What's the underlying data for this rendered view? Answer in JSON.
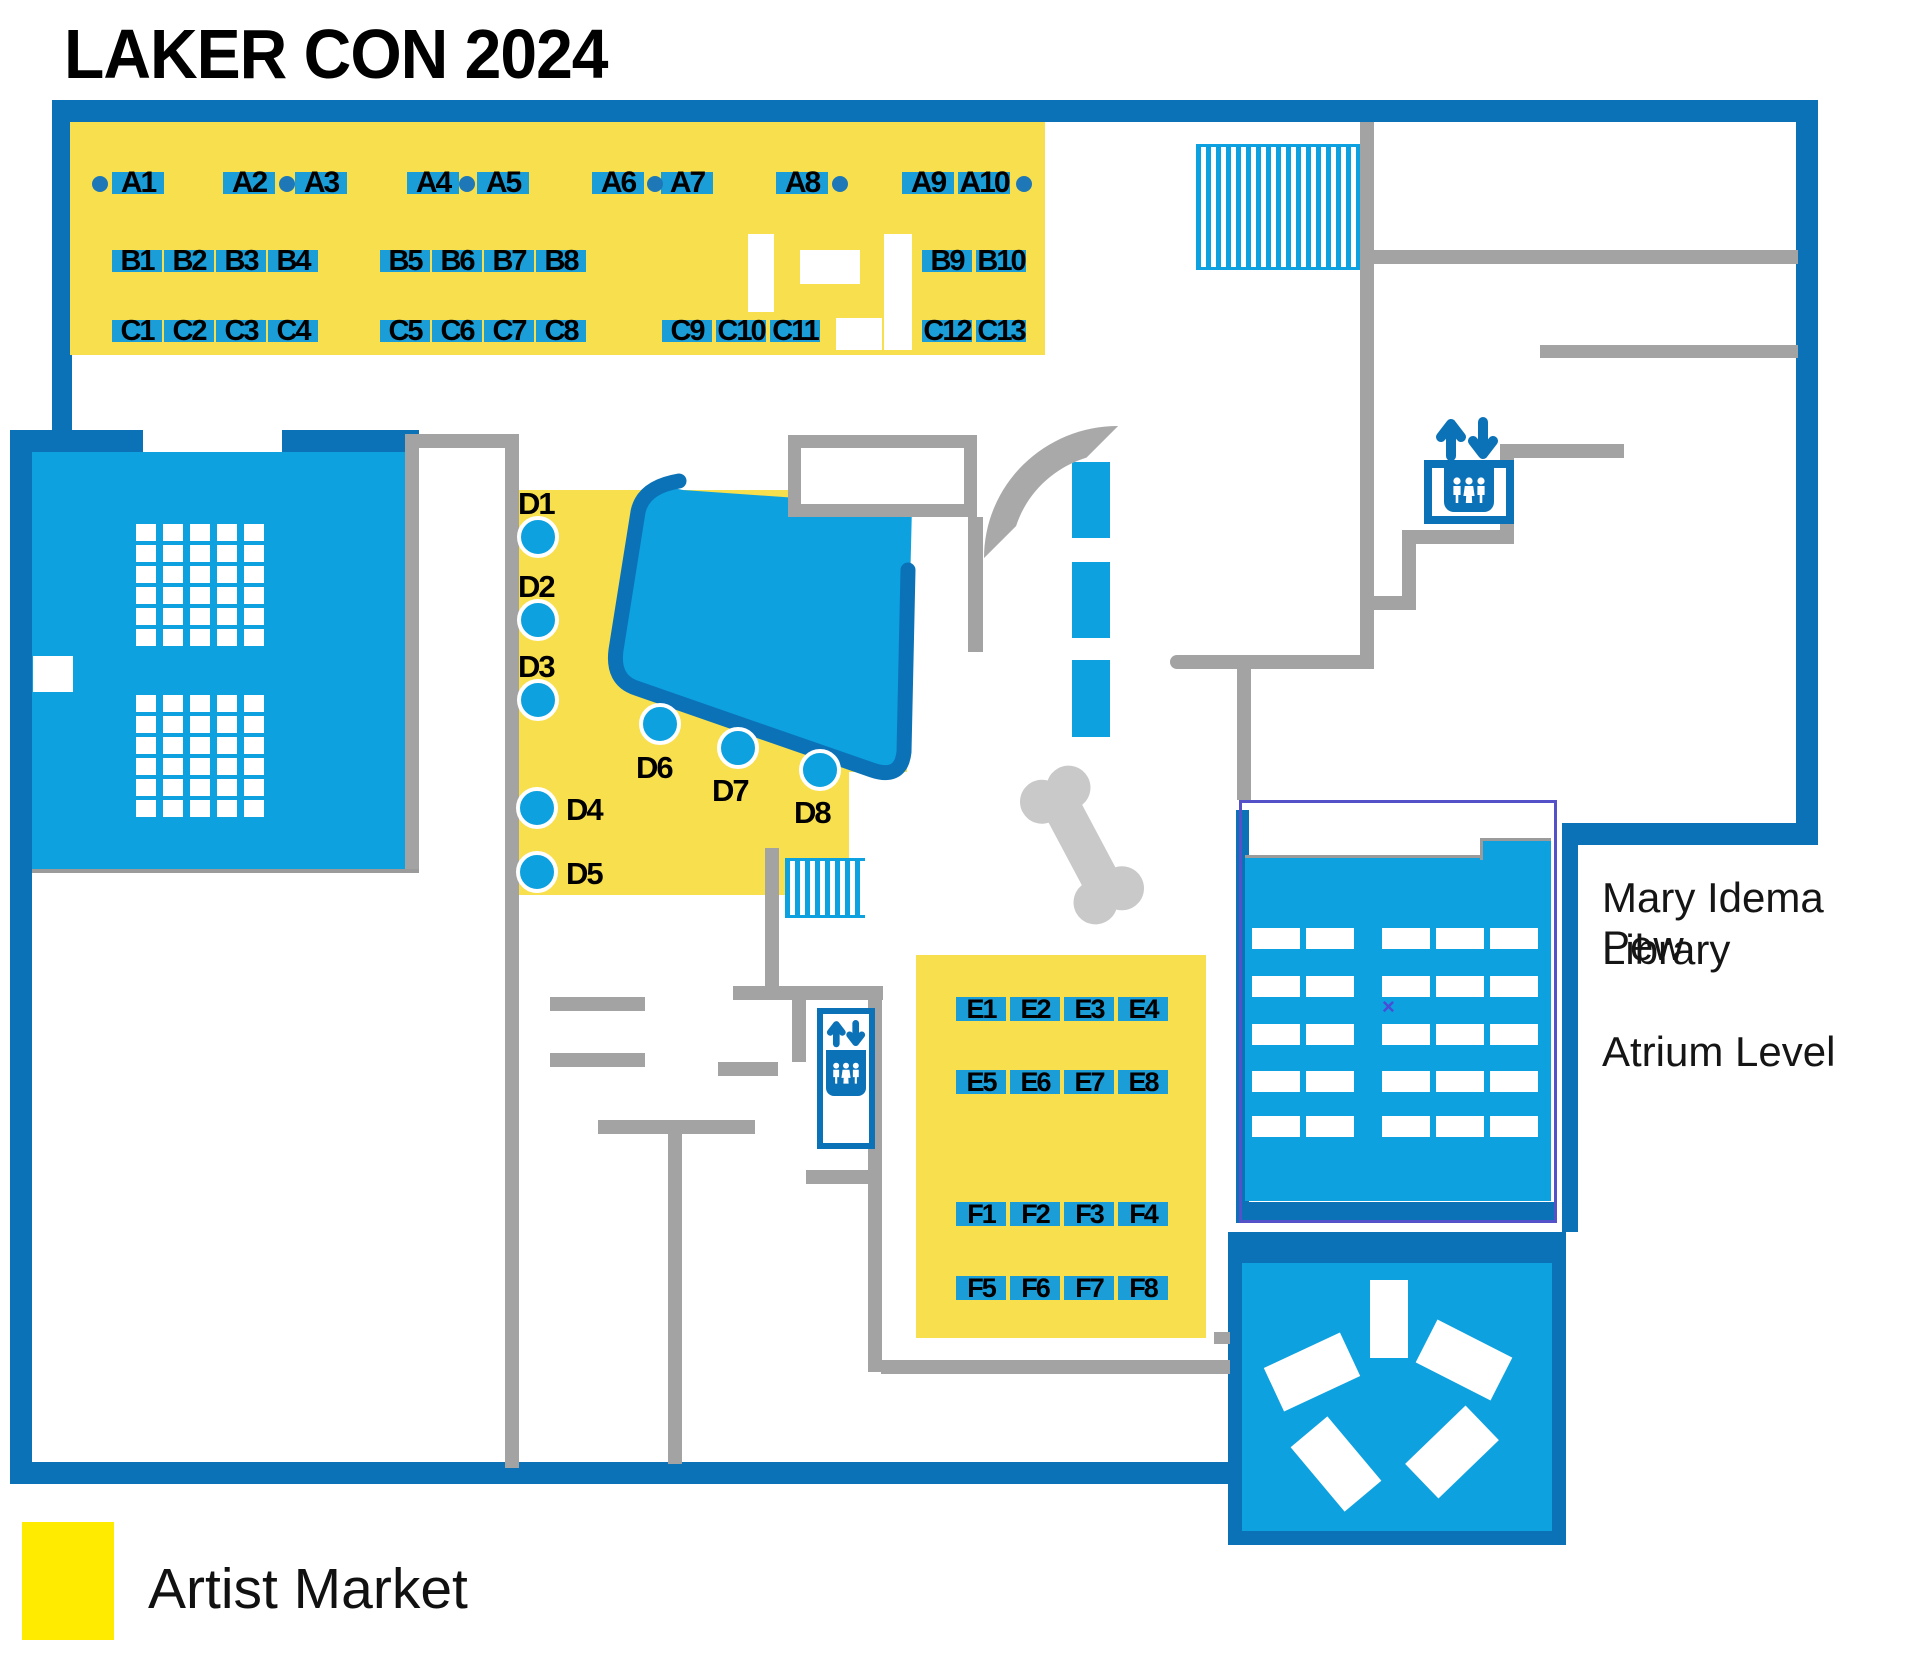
{
  "title": "LAKER CON 2024",
  "legend": {
    "label": "Artist Market",
    "swatch_color": "#FFEB00"
  },
  "library_label": {
    "line1": "Mary Idema Pew",
    "line2": "Library",
    "line3": "Atrium Level"
  },
  "map": {
    "x_marker": "×"
  },
  "booths": {
    "a": [
      "A1",
      "A2",
      "A3",
      "A4",
      "A5",
      "A6",
      "A7",
      "A8",
      "A9",
      "A10"
    ],
    "b": [
      "B1",
      "B2",
      "B3",
      "B4",
      "B5",
      "B6",
      "B7",
      "B8",
      "B9",
      "B10"
    ],
    "c": [
      "C1",
      "C2",
      "C3",
      "C4",
      "C5",
      "C6",
      "C7",
      "C8",
      "C9",
      "C10",
      "C11",
      "C12",
      "C13"
    ],
    "d": [
      "D1",
      "D2",
      "D3",
      "D4",
      "D5",
      "D6",
      "D7",
      "D8"
    ],
    "e": [
      "E1",
      "E2",
      "E3",
      "E4",
      "E5",
      "E6",
      "E7",
      "E8"
    ],
    "f": [
      "F1",
      "F2",
      "F3",
      "F4",
      "F5",
      "F6",
      "F7",
      "F8"
    ]
  },
  "icons": {
    "upper_elevator": "elevator-icon",
    "lower_elevator": "elevator-icon",
    "arrows": "up-down-arrows-icon",
    "people": "people-icon",
    "stairs": "stairs-hatch"
  },
  "colors": {
    "dark_blue": "#0B72B8",
    "bright_blue": "#0DA1E0",
    "booth_blue": "#1B9DD8",
    "dot_blue": "#1E78B8",
    "yellow": "#F8DF4D",
    "legend_yellow": "#FFEB00",
    "wall_gray": "#A3A3A3",
    "light_gray": "#C9C9C9",
    "purple": "#5552C9"
  }
}
